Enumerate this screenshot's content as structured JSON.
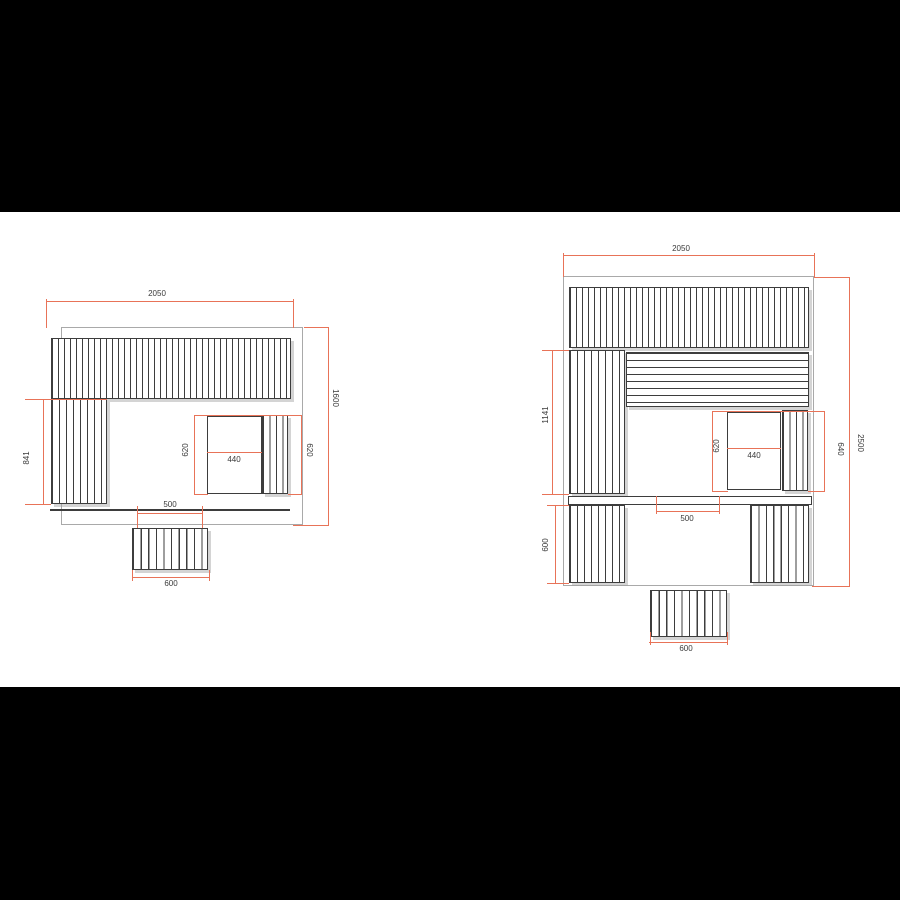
{
  "colors": {
    "dimension_line": "#e87358",
    "drawing_line": "#3d3d3d",
    "wall_outline": "#a9a9a9",
    "background": "#ffffff",
    "letterbox": "#000000"
  },
  "left_plan": {
    "dims": {
      "width": "2050",
      "height": "1600",
      "bench_length": "841",
      "heater_clearance_left": "620",
      "heater_width": "440",
      "heater_clearance_right": "620",
      "step_inner_width": "500",
      "step_width": "600"
    }
  },
  "right_plan": {
    "dims": {
      "width": "2050",
      "height": "2500",
      "bench_length": "1141",
      "heater_clearance_left": "620",
      "heater_width": "440",
      "bench_right_length": "640",
      "step_inner_width": "500",
      "lower_bench_depth": "600",
      "step_width": "600"
    }
  }
}
